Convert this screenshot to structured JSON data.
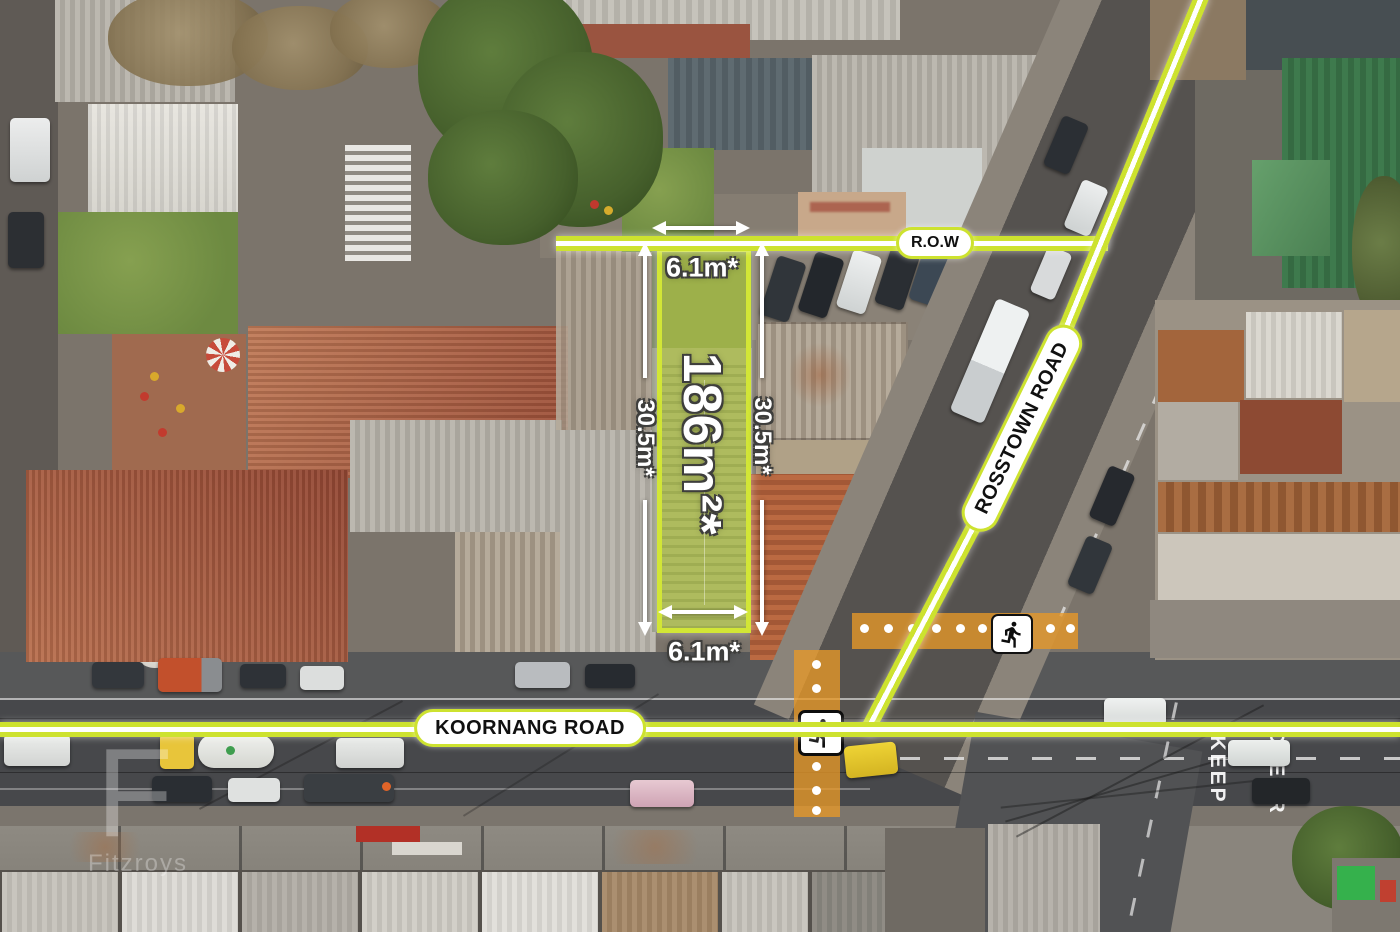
{
  "lot": {
    "area": "186m²*",
    "frontage_top": "6.1m*",
    "frontage_bottom": "6.1m*",
    "depth_left": "30.5m*",
    "depth_right": "30.5m*"
  },
  "roads": {
    "row": "R.O.W",
    "rosstown": "ROSSTOWN ROAD",
    "koornang": "KOORNANG ROAD"
  },
  "pavement_markings": {
    "keep": "KEEP",
    "clear": "CLEAR"
  },
  "watermark": {
    "initial": "F",
    "name": "Fitzroys"
  },
  "icons": [
    {
      "name": "pedestrian-icon",
      "location": "east-crossing"
    },
    {
      "name": "pedestrian-icon",
      "location": "south-crossing"
    }
  ],
  "colors": {
    "highlight_green": "#cde22f",
    "line_core_white": "#ffffff",
    "lot_fill": "rgba(205,228,48,0.45)",
    "crossing_orange": "rgba(232,152,40,0.78)",
    "pill_text": "#101010",
    "dimension_text": "#ffffff"
  }
}
